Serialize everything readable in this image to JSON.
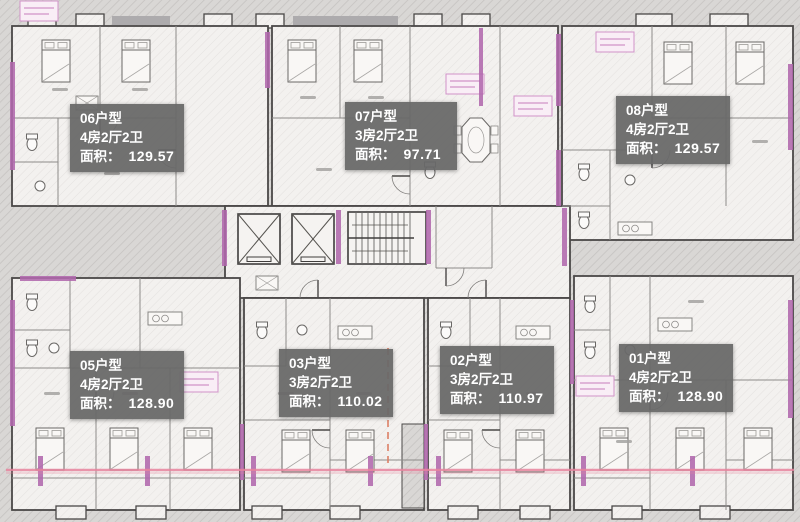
{
  "units": [
    {
      "id": "06",
      "code": "06户型",
      "rooms": "4房2厅2卫",
      "area_label": "面积：",
      "area_value": "129.57"
    },
    {
      "id": "07",
      "code": "07户型",
      "rooms": "3房2厅2卫",
      "area_label": "面积：",
      "area_value": "97.71"
    },
    {
      "id": "08",
      "code": "08户型",
      "rooms": "4房2厅2卫",
      "area_label": "面积：",
      "area_value": "129.57"
    },
    {
      "id": "05",
      "code": "05户型",
      "rooms": "4房2厅2卫",
      "area_label": "面积：",
      "area_value": "128.90"
    },
    {
      "id": "03",
      "code": "03户型",
      "rooms": "3房2厅2卫",
      "area_label": "面积：",
      "area_value": "110.02"
    },
    {
      "id": "02",
      "code": "02户型",
      "rooms": "3房2厅2卫",
      "area_label": "面积：",
      "area_value": "110.97"
    },
    {
      "id": "01",
      "code": "01户型",
      "rooms": "4房2厅2卫",
      "area_label": "面积：",
      "area_value": "128.90"
    }
  ],
  "colors": {
    "wall_accent": "#b168ad",
    "label_bg": "#686868",
    "label_text": "#ffffff",
    "guide_line": "#e8849e",
    "dim_tag": "#d193c8",
    "background": "#dddbd9"
  }
}
